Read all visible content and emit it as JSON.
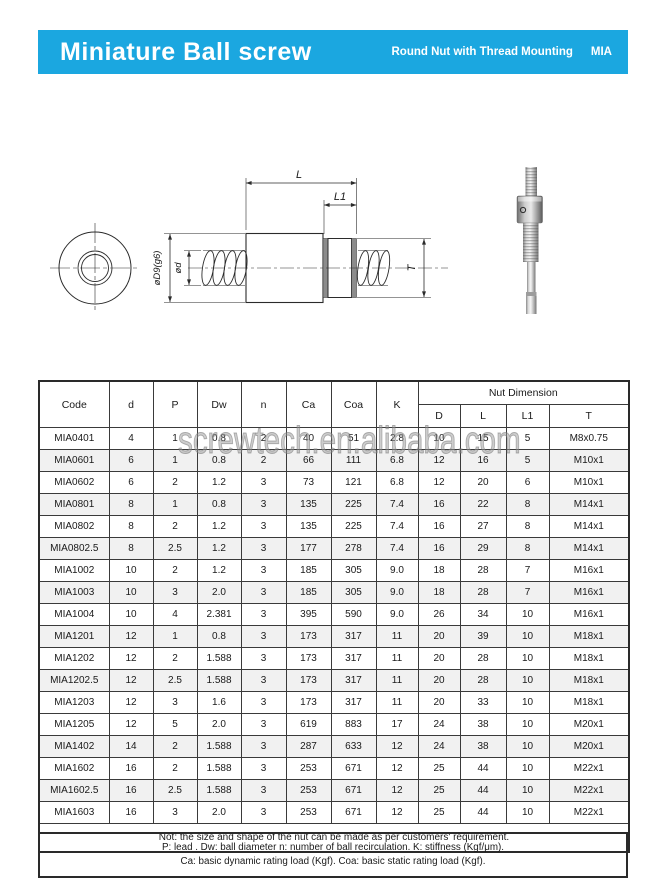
{
  "banner": {
    "title": "Miniature Ball screw",
    "subtitle": "Round Nut with Thread Mounting",
    "series_code": "MIA",
    "bg_color": "#1ba7e0"
  },
  "drawing": {
    "dim_L": "L",
    "dim_L1": "L1",
    "dim_T": "T",
    "dim_d": "ød",
    "dim_D": "øD9(g6)"
  },
  "watermark": "screwtech.en.alibaba.com",
  "table": {
    "headers": {
      "code": "Code",
      "d": "d",
      "P": "P",
      "Dw": "Dw",
      "n": "n",
      "Ca": "Ca",
      "Coa": "Coa",
      "K": "K",
      "nut_dimension": "Nut Dimension",
      "D": "D",
      "L": "L",
      "L1": "L1",
      "T": "T"
    },
    "rows": [
      {
        "code": "MIA0401",
        "d": "4",
        "P": "1",
        "Dw": "0.8",
        "n": "2",
        "Ca": "40",
        "Coa": "51",
        "K": "2.8",
        "D": "10",
        "L": "15",
        "L1": "5",
        "T": "M8x0.75",
        "shaded": false
      },
      {
        "code": "MIA0601",
        "d": "6",
        "P": "1",
        "Dw": "0.8",
        "n": "2",
        "Ca": "66",
        "Coa": "111",
        "K": "6.8",
        "D": "12",
        "L": "16",
        "L1": "5",
        "T": "M10x1",
        "shaded": true
      },
      {
        "code": "MIA0602",
        "d": "6",
        "P": "2",
        "Dw": "1.2",
        "n": "3",
        "Ca": "73",
        "Coa": "121",
        "K": "6.8",
        "D": "12",
        "L": "20",
        "L1": "6",
        "T": "M10x1",
        "shaded": false
      },
      {
        "code": "MIA0801",
        "d": "8",
        "P": "1",
        "Dw": "0.8",
        "n": "3",
        "Ca": "135",
        "Coa": "225",
        "K": "7.4",
        "D": "16",
        "L": "22",
        "L1": "8",
        "T": "M14x1",
        "shaded": true
      },
      {
        "code": "MIA0802",
        "d": "8",
        "P": "2",
        "Dw": "1.2",
        "n": "3",
        "Ca": "135",
        "Coa": "225",
        "K": "7.4",
        "D": "16",
        "L": "27",
        "L1": "8",
        "T": "M14x1",
        "shaded": false
      },
      {
        "code": "MIA0802.5",
        "d": "8",
        "P": "2.5",
        "Dw": "1.2",
        "n": "3",
        "Ca": "177",
        "Coa": "278",
        "K": "7.4",
        "D": "16",
        "L": "29",
        "L1": "8",
        "T": "M14x1",
        "shaded": true
      },
      {
        "code": "MIA1002",
        "d": "10",
        "P": "2",
        "Dw": "1.2",
        "n": "3",
        "Ca": "185",
        "Coa": "305",
        "K": "9.0",
        "D": "18",
        "L": "28",
        "L1": "7",
        "T": "M16x1",
        "shaded": false
      },
      {
        "code": "MIA1003",
        "d": "10",
        "P": "3",
        "Dw": "2.0",
        "n": "3",
        "Ca": "185",
        "Coa": "305",
        "K": "9.0",
        "D": "18",
        "L": "28",
        "L1": "7",
        "T": "M16x1",
        "shaded": true
      },
      {
        "code": "MIA1004",
        "d": "10",
        "P": "4",
        "Dw": "2.381",
        "n": "3",
        "Ca": "395",
        "Coa": "590",
        "K": "9.0",
        "D": "26",
        "L": "34",
        "L1": "10",
        "T": "M16x1",
        "shaded": false
      },
      {
        "code": "MIA1201",
        "d": "12",
        "P": "1",
        "Dw": "0.8",
        "n": "3",
        "Ca": "173",
        "Coa": "317",
        "K": "11",
        "D": "20",
        "L": "39",
        "L1": "10",
        "T": "M18x1",
        "shaded": true
      },
      {
        "code": "MIA1202",
        "d": "12",
        "P": "2",
        "Dw": "1.588",
        "n": "3",
        "Ca": "173",
        "Coa": "317",
        "K": "11",
        "D": "20",
        "L": "28",
        "L1": "10",
        "T": "M18x1",
        "shaded": false
      },
      {
        "code": "MIA1202.5",
        "d": "12",
        "P": "2.5",
        "Dw": "1.588",
        "n": "3",
        "Ca": "173",
        "Coa": "317",
        "K": "11",
        "D": "20",
        "L": "28",
        "L1": "10",
        "T": "M18x1",
        "shaded": true
      },
      {
        "code": "MIA1203",
        "d": "12",
        "P": "3",
        "Dw": "1.6",
        "n": "3",
        "Ca": "173",
        "Coa": "317",
        "K": "11",
        "D": "20",
        "L": "33",
        "L1": "10",
        "T": "M18x1",
        "shaded": false
      },
      {
        "code": "MIA1205",
        "d": "12",
        "P": "5",
        "Dw": "2.0",
        "n": "3",
        "Ca": "619",
        "Coa": "883",
        "K": "17",
        "D": "24",
        "L": "38",
        "L1": "10",
        "T": "M20x1",
        "shaded": false
      },
      {
        "code": "MIA1402",
        "d": "14",
        "P": "2",
        "Dw": "1.588",
        "n": "3",
        "Ca": "287",
        "Coa": "633",
        "K": "12",
        "D": "24",
        "L": "38",
        "L1": "10",
        "T": "M20x1",
        "shaded": true
      },
      {
        "code": "MIA1602",
        "d": "16",
        "P": "2",
        "Dw": "1.588",
        "n": "3",
        "Ca": "253",
        "Coa": "671",
        "K": "12",
        "D": "25",
        "L": "44",
        "L1": "10",
        "T": "M22x1",
        "shaded": false
      },
      {
        "code": "MIA1602.5",
        "d": "16",
        "P": "2.5",
        "Dw": "1.588",
        "n": "3",
        "Ca": "253",
        "Coa": "671",
        "K": "12",
        "D": "25",
        "L": "44",
        "L1": "10",
        "T": "M22x1",
        "shaded": true
      },
      {
        "code": "MIA1603",
        "d": "16",
        "P": "3",
        "Dw": "2.0",
        "n": "3",
        "Ca": "253",
        "Coa": "671",
        "K": "12",
        "D": "25",
        "L": "44",
        "L1": "10",
        "T": "M22x1",
        "shaded": false
      }
    ],
    "note": "Not: the size and shape of the nut can be made as per customers' requirement."
  },
  "legend": {
    "line1": "P: lead . Dw: ball diameter n: number of ball recirculation. K: stiffness (Kgf/μm).",
    "line2": "Ca: basic dynamic rating load (Kgf). Coa: basic static rating load (Kgf)."
  }
}
